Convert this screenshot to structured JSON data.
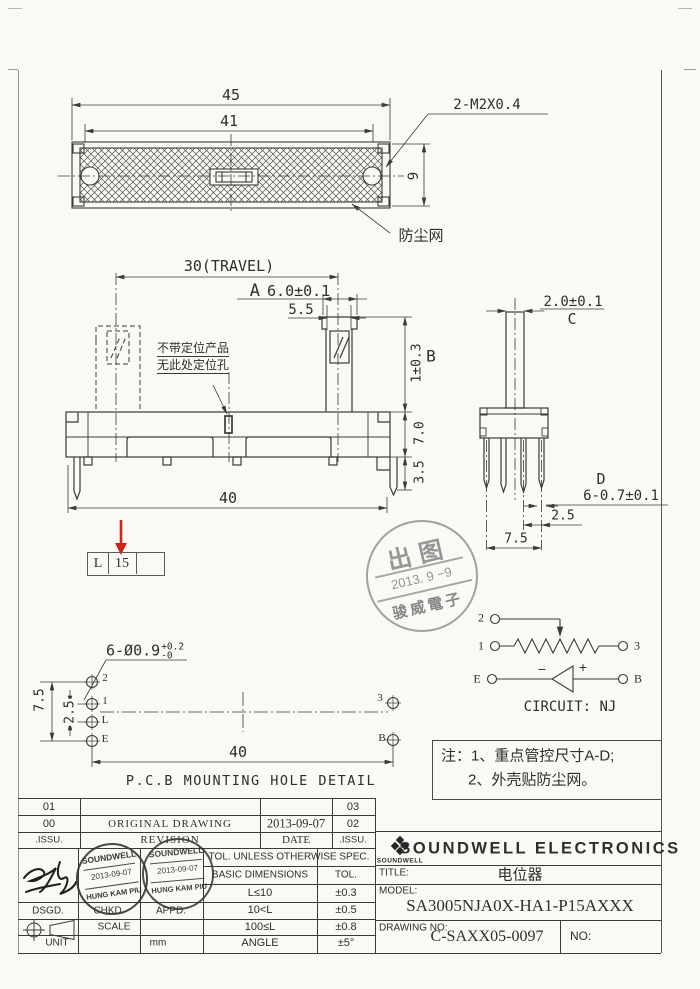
{
  "colors": {
    "paper": "#faf9f5",
    "line": "#3a3a3a",
    "red": "#cf2218",
    "stamp_gray": "#8e8e8e"
  },
  "top_view": {
    "dim45": "45",
    "dim41": "41",
    "dim9": "9",
    "screw_label": "2-M2X0.4",
    "dust_label": "防尘网"
  },
  "front_view": {
    "travel": "30(TRAVEL)",
    "a_label": "A",
    "a_val": "6.0±0.1",
    "dim55": "5.5",
    "b_label": "B",
    "b_val": "1±0.3",
    "dim70": "7.0",
    "dim35": "3.5",
    "dim40": "40",
    "note1": "不带定位产品",
    "note2": "无此处定位孔"
  },
  "side_view": {
    "c_val": "2.0±0.1",
    "c_label": "C",
    "d_label": "D",
    "d_val": "6-0.7±0.1",
    "dim25": "2.5",
    "dim75": "7.5"
  },
  "travel_code": {
    "c1": "L",
    "c2": "15",
    "c3": ""
  },
  "release_stamp": {
    "l1": "出图",
    "l2": "2013. 9 −9",
    "l3": "骏威電子"
  },
  "circuit": {
    "t2": "2",
    "t1": "1",
    "t3": "3",
    "tE": "E",
    "tB": "B",
    "minus": "−",
    "plus": "+",
    "led": "LED",
    "caption": "CIRCUIT: NJ"
  },
  "pcb": {
    "callout": "6-Ø0.9",
    "tol_up": "+0.2",
    "tol_dn": "-0",
    "d75": "7.5",
    "d25": "2.5",
    "d40": "40",
    "h2": "2",
    "h1": "1",
    "hL": "L",
    "hE": "E",
    "h3": "3",
    "hB": "B",
    "caption": "P.C.B MOUNTING HOLE DETAIL"
  },
  "notes": {
    "line1": "注：1、重点管控尺寸A-D;",
    "line2": "2、外壳贴防尘网。"
  },
  "revision": {
    "r1c1": "01",
    "r1c4": "03",
    "r2c1": "00",
    "r2c2": "ORIGINAL DRAWING",
    "r2c3": "2013-09-07",
    "r2c4": "02",
    "r3c1": ".ISSU.",
    "r3c2": "REVISION",
    "r3c3": "DATE",
    "r3c4": ".ISSU."
  },
  "tolerance": {
    "header": "TOL. UNLESS OTHERWISE SPEC.",
    "col1": "BASIC DIMENSIONS",
    "col2": "TOL.",
    "rows": [
      [
        "L≤10",
        "±0.3"
      ],
      [
        "10<L",
        "±0.5"
      ],
      [
        "100≤L",
        "±0.8"
      ],
      [
        "ANGLE",
        "±5°"
      ]
    ]
  },
  "sign": {
    "dsgd": "DSGD.",
    "chkd": "CHKD.",
    "appd": "APPD.",
    "scale": "SCALE",
    "unit": "UNIT",
    "unit_val": "mm"
  },
  "approval_stamp": {
    "l1": "SOUNDWELL",
    "l2": "2013-09-07",
    "l3": "HUNG KAM PIU"
  },
  "company": {
    "logo_text": "SOUNDWELL",
    "name": "SOUNDWELL ELECTRONICS",
    "title_label": "TITLE:",
    "title_val": "电位器",
    "model_label": "MODEL:",
    "model_val": "SA3005NJA0X-HA1-P15AXXX",
    "drawing_label": "DRAWING NO:",
    "drawing_val": "C-SAXX05-0097",
    "no_label": "NO:"
  }
}
